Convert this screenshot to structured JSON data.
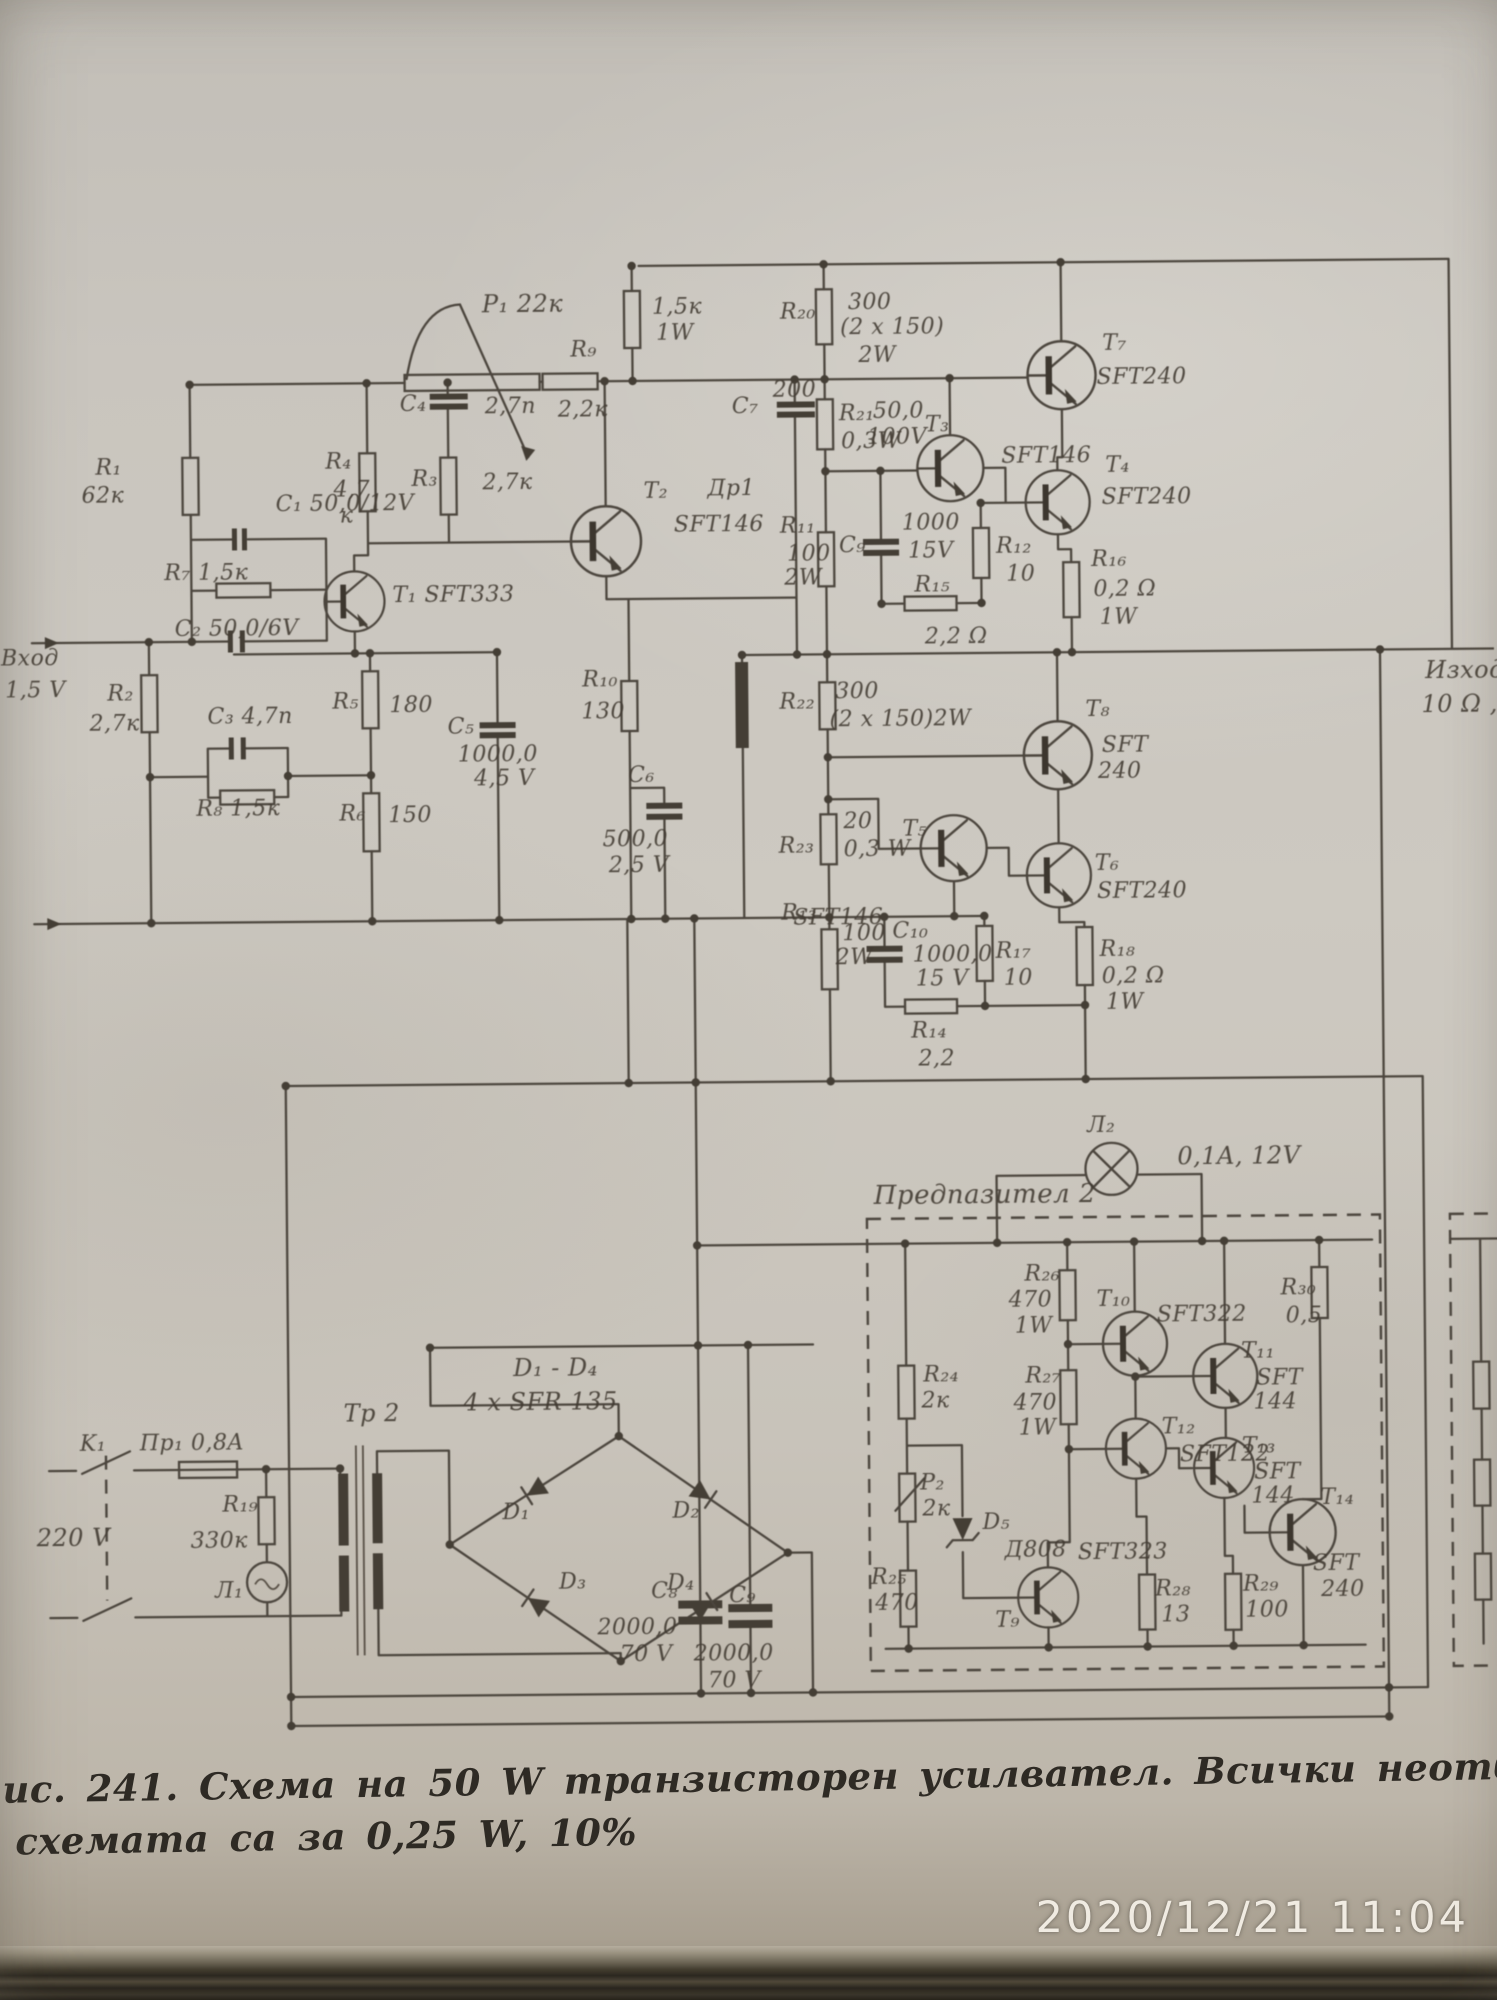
{
  "colors": {
    "paper": "#c9c5be",
    "ink": "#4b453d",
    "label_ink": "#423b32",
    "timestamp_text": "#f0ebe2"
  },
  "camera": {
    "timestamp": "2020/12/21  11:04"
  },
  "caption": {
    "line1": "ис. 241.  Схема  на  50  W  транзисторен  усилвател.  Всички  неотбел",
    "line2": "схемата  са  за  0,25  W,  10%"
  },
  "schematic": {
    "title_implied": "50 W транзисторен усилвател",
    "labels": [
      [
        488,
        288,
        "P₁ 22к",
        24
      ],
      [
        100,
        450,
        "R₁"
      ],
      [
        86,
        478,
        "62к"
      ],
      [
        280,
        488,
        "C₁ 50,0/12V"
      ],
      [
        330,
        446,
        "R₄"
      ],
      [
        338,
        474,
        "4,7"
      ],
      [
        344,
        500,
        "к"
      ],
      [
        405,
        389,
        "C₄"
      ],
      [
        490,
        392,
        "2,7n"
      ],
      [
        416,
        464,
        "R₃"
      ],
      [
        487,
        468,
        "2,7к"
      ],
      [
        168,
        556,
        "R₇ 1,5к"
      ],
      [
        396,
        580,
        "T₁ SFT333"
      ],
      [
        178,
        612,
        "C₂ 50,0/6V"
      ],
      [
        4,
        640,
        "Вход"
      ],
      [
        8,
        672,
        "1,5 V"
      ],
      [
        110,
        676,
        "R₂"
      ],
      [
        92,
        706,
        "2,7к"
      ],
      [
        210,
        700,
        "C₃ 4,7n"
      ],
      [
        335,
        686,
        "R₅"
      ],
      [
        392,
        690,
        "180"
      ],
      [
        450,
        712,
        "C₅"
      ],
      [
        460,
        740,
        "1000,0"
      ],
      [
        476,
        764,
        "4,5 V"
      ],
      [
        198,
        792,
        "R₈ 1,5к"
      ],
      [
        341,
        798,
        "R₆"
      ],
      [
        390,
        800,
        "150"
      ],
      [
        576,
        336,
        "R₉"
      ],
      [
        563,
        396,
        "2,2к"
      ],
      [
        658,
        294,
        "1,5к"
      ],
      [
        662,
        320,
        "1W"
      ],
      [
        737,
        394,
        "C₇"
      ],
      [
        878,
        400,
        "50,0"
      ],
      [
        872,
        426,
        "100V"
      ],
      [
        648,
        478,
        "T₂"
      ],
      [
        678,
        512,
        "SFT146"
      ],
      [
        712,
        476,
        "Др1"
      ],
      [
        786,
        300,
        "R₂₀"
      ],
      [
        854,
        291,
        "300"
      ],
      [
        846,
        316,
        "(2 x 150)"
      ],
      [
        864,
        344,
        "2W"
      ],
      [
        1108,
        334,
        "T₇"
      ],
      [
        1102,
        368,
        "SFT240"
      ],
      [
        778,
        378,
        "200"
      ],
      [
        844,
        402,
        "R₂₁"
      ],
      [
        846,
        430,
        "0,3W"
      ],
      [
        930,
        414,
        "T₃"
      ],
      [
        1006,
        446,
        "SFT146"
      ],
      [
        1110,
        456,
        "T₄"
      ],
      [
        1106,
        488,
        "SFT240"
      ],
      [
        784,
        514,
        "R₁₁"
      ],
      [
        791,
        542,
        "100"
      ],
      [
        788,
        566,
        "2W"
      ],
      [
        843,
        534,
        "C₉"
      ],
      [
        906,
        512,
        "1000"
      ],
      [
        912,
        540,
        "15V"
      ],
      [
        1000,
        536,
        "R₁₂"
      ],
      [
        1010,
        564,
        "10"
      ],
      [
        918,
        574,
        "R₁₅"
      ],
      [
        928,
        626,
        "2,2 Ω"
      ],
      [
        1095,
        550,
        "R₁₆"
      ],
      [
        1097,
        580,
        "0,2 Ω"
      ],
      [
        1103,
        608,
        "1W"
      ],
      [
        630,
        762,
        "C₆"
      ],
      [
        604,
        826,
        "500,0"
      ],
      [
        610,
        852,
        "2,5 V"
      ],
      [
        585,
        666,
        "R₁₀"
      ],
      [
        584,
        698,
        "130"
      ],
      [
        782,
        690,
        "R₂₂"
      ],
      [
        838,
        680,
        "300"
      ],
      [
        832,
        708,
        "(2 x 150)2W"
      ],
      [
        1088,
        700,
        "T₈"
      ],
      [
        1104,
        736,
        "SFT"
      ],
      [
        1100,
        762,
        "240"
      ],
      [
        780,
        834,
        "R₂₃"
      ],
      [
        845,
        810,
        "20"
      ],
      [
        845,
        838,
        "0,3 W"
      ],
      [
        904,
        818,
        "T₅"
      ],
      [
        794,
        906,
        "SFT146"
      ],
      [
        1096,
        854,
        "T₆"
      ],
      [
        1098,
        882,
        "SFT240"
      ],
      [
        782,
        901,
        "R₁₃"
      ],
      [
        843,
        922,
        "100"
      ],
      [
        836,
        946,
        "2W"
      ],
      [
        893,
        920,
        "C₁₀"
      ],
      [
        913,
        944,
        "1000,0"
      ],
      [
        916,
        968,
        "15 V"
      ],
      [
        996,
        941,
        "R₁₇"
      ],
      [
        1004,
        968,
        "10"
      ],
      [
        1100,
        940,
        "R₁₈"
      ],
      [
        1102,
        967,
        "0,2 Ω"
      ],
      [
        1106,
        993,
        "1W"
      ],
      [
        911,
        1020,
        "R₁₄"
      ],
      [
        918,
        1048,
        "2,2"
      ],
      [
        1428,
        662,
        "Изход",
        24
      ],
      [
        1424,
        696,
        "10 Ω ,",
        24
      ],
      [
        76,
        1426,
        "K₁"
      ],
      [
        136,
        1426,
        "Пр₁ 0,8A"
      ],
      [
        32,
        1518,
        "220 V",
        24
      ],
      [
        218,
        1488,
        "R₁₉"
      ],
      [
        186,
        1524,
        "330к"
      ],
      [
        210,
        1574,
        "Л₁"
      ],
      [
        340,
        1396,
        "Тр 2",
        24
      ],
      [
        510,
        1352,
        "D₁ - D₄",
        24
      ],
      [
        460,
        1386,
        "4 x SFR 135",
        24
      ],
      [
        498,
        1498,
        "D₁"
      ],
      [
        668,
        1498,
        "D₂"
      ],
      [
        554,
        1568,
        "D₃"
      ],
      [
        662,
        1570,
        "D₄"
      ],
      [
        646,
        1578,
        "C₈"
      ],
      [
        592,
        1614,
        "2000,0"
      ],
      [
        614,
        1641,
        "70 V"
      ],
      [
        724,
        1583,
        "C₉"
      ],
      [
        688,
        1641,
        "2000,0"
      ],
      [
        702,
        1668,
        "70 V"
      ],
      [
        872,
        1182,
        "Предпазител 2",
        26
      ],
      [
        1086,
        1116,
        "Л₂"
      ],
      [
        1176,
        1146,
        "0,1A, 12V",
        24
      ],
      [
        1022,
        1264,
        "R₂₆"
      ],
      [
        1006,
        1290,
        "470"
      ],
      [
        1012,
        1316,
        "1W"
      ],
      [
        1094,
        1290,
        "T₁₀"
      ],
      [
        1154,
        1306,
        "SFT322"
      ],
      [
        920,
        1364,
        "R₂₄"
      ],
      [
        918,
        1390,
        "2к"
      ],
      [
        1022,
        1366,
        "R₂₇"
      ],
      [
        1010,
        1393,
        "470"
      ],
      [
        1015,
        1418,
        "1W"
      ],
      [
        1278,
        1280,
        "R₃₀"
      ],
      [
        1283,
        1308,
        "0,5"
      ],
      [
        1238,
        1343,
        "T₁₁"
      ],
      [
        1253,
        1370,
        "SFT"
      ],
      [
        1250,
        1394,
        "144"
      ],
      [
        1158,
        1418,
        "T₁₂"
      ],
      [
        1176,
        1446,
        "SFT122"
      ],
      [
        916,
        1472,
        "P₂"
      ],
      [
        918,
        1498,
        "2к"
      ],
      [
        978,
        1512,
        "D₅"
      ],
      [
        1000,
        1540,
        "Д808"
      ],
      [
        1073,
        1543,
        "SFT323"
      ],
      [
        990,
        1610,
        "T₉"
      ],
      [
        866,
        1566,
        "R₂₅"
      ],
      [
        870,
        1592,
        "470"
      ],
      [
        1238,
        1438,
        "T₁₃"
      ],
      [
        1250,
        1464,
        "SFT"
      ],
      [
        1247,
        1488,
        "144"
      ],
      [
        1316,
        1490,
        "T₁₄"
      ],
      [
        1308,
        1556,
        "SFT"
      ],
      [
        1316,
        1582,
        "240"
      ],
      [
        1150,
        1580,
        "R₂₈"
      ],
      [
        1156,
        1606,
        "13"
      ],
      [
        1238,
        1576,
        "R₂₉"
      ],
      [
        1240,
        1602,
        "100"
      ]
    ]
  }
}
